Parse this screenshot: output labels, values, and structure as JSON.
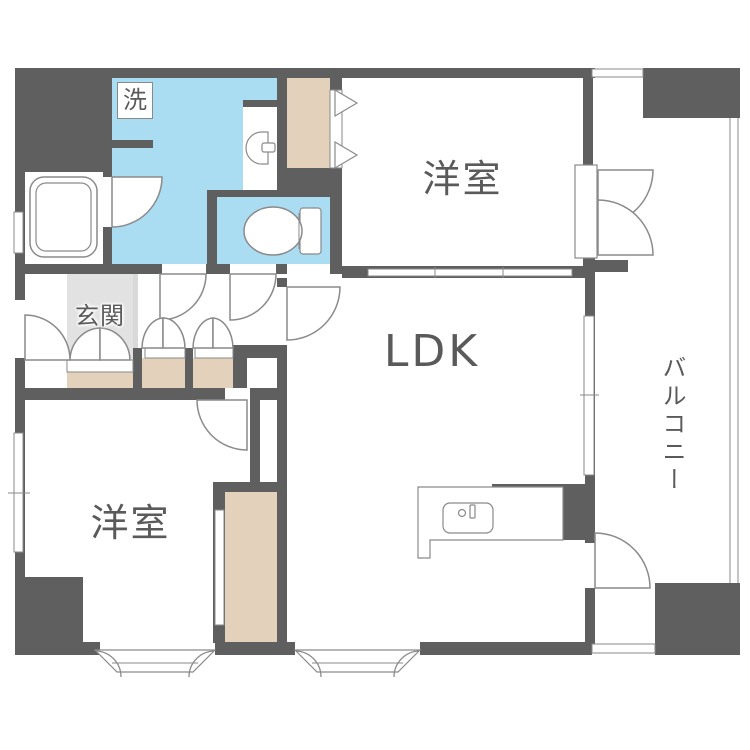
{
  "labels": {
    "bedroom_top": "洋室",
    "bedroom_bottom": "洋室",
    "ldk": "LDK",
    "balcony": "バルコニー",
    "entrance": "玄関",
    "laundry": "洗"
  },
  "colors": {
    "wall": "#5f5f5f",
    "wet_area": "#aadcf2",
    "closet": "#e3d1bc",
    "entrance_floor": "#e2e2e2",
    "entrance_step": "#d9d9d9",
    "line": "#8a8a8a",
    "label_text": "#5a5a5a"
  }
}
